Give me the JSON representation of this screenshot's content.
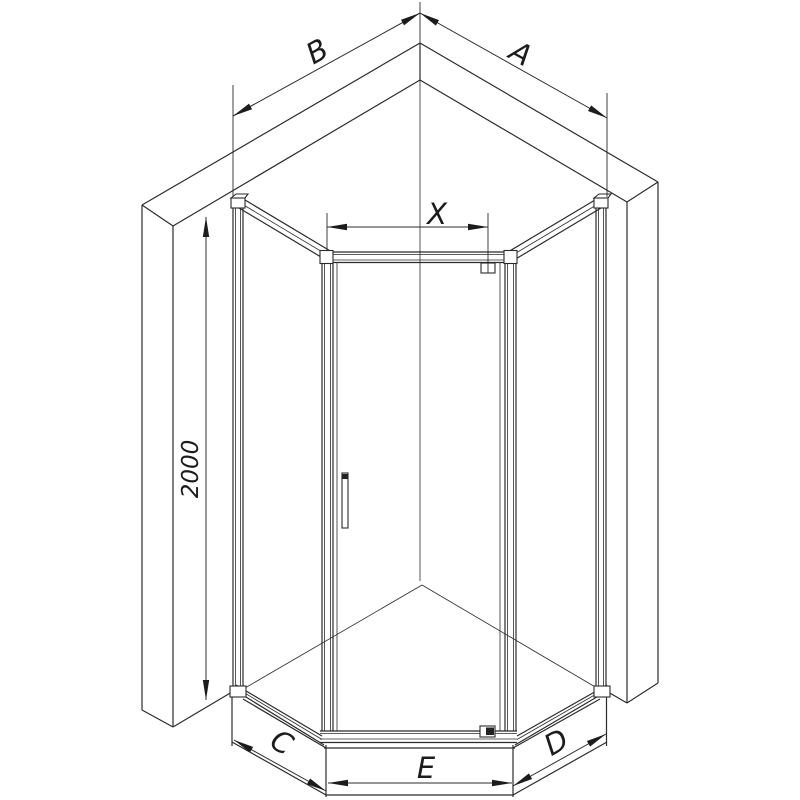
{
  "diagram": {
    "labels": {
      "a": "A",
      "b": "B",
      "c": "C",
      "d": "D",
      "e": "E",
      "x": "X",
      "height": "2000"
    },
    "colors": {
      "line": "#2b2b2b",
      "background": "#ffffff",
      "fill_dark": "#222222"
    }
  }
}
